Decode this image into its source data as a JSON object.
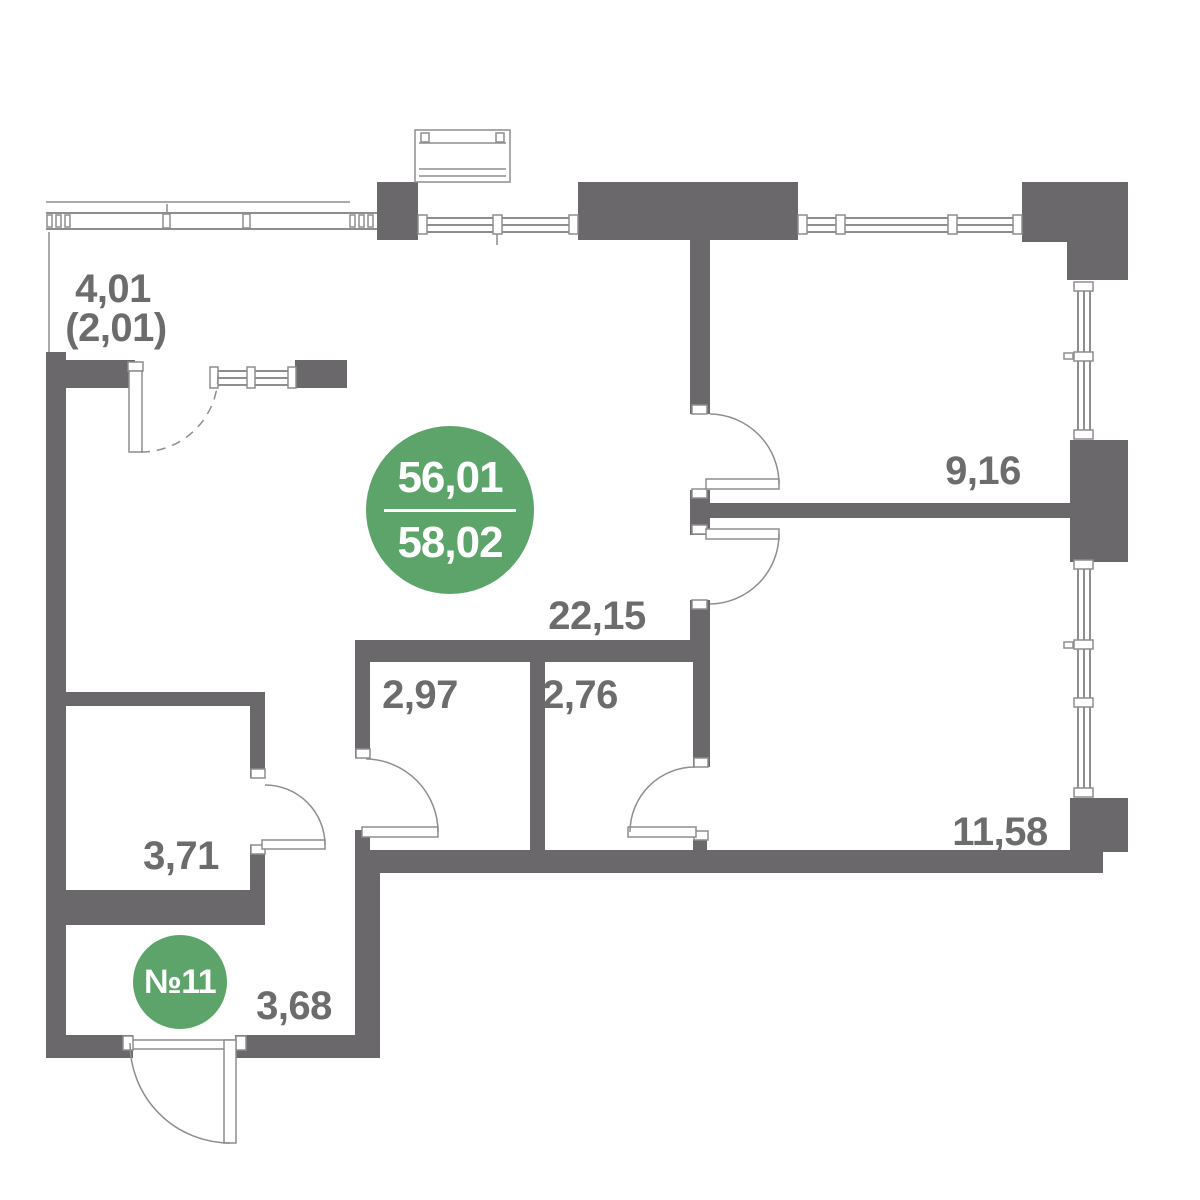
{
  "colors": {
    "wall": "#6a686a",
    "accent": "#5ca469",
    "label": "#6d6c6d",
    "line": "#8e8e8e"
  },
  "badges": {
    "area": {
      "top": "56,01",
      "bottom": "58,02"
    },
    "unit": {
      "number": "№11"
    }
  },
  "rooms": {
    "balcony": {
      "area": "4,01",
      "area_reduced": "(2,01)"
    },
    "bedroom_top": {
      "area": "9,16"
    },
    "living": {
      "area": "22,15"
    },
    "storage_left": {
      "area": "2,97"
    },
    "storage_right": {
      "area": "2,76"
    },
    "bathroom": {
      "area": "3,71"
    },
    "bedroom_bottom": {
      "area": "11,58"
    },
    "entry": {
      "area": "3,68"
    }
  }
}
